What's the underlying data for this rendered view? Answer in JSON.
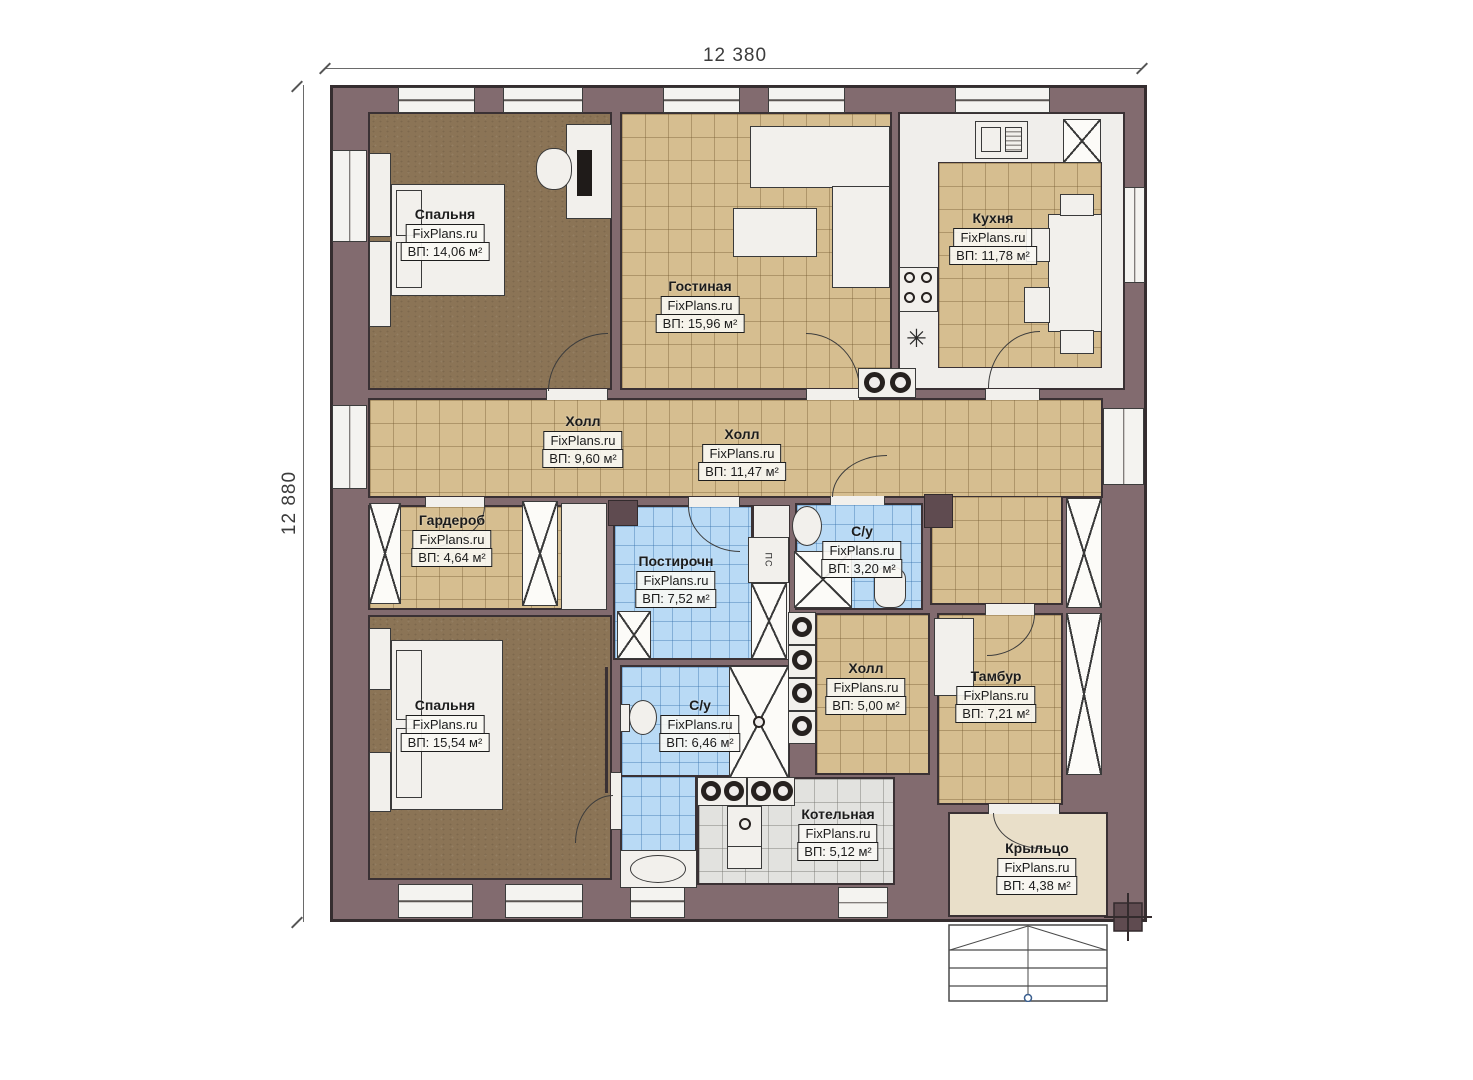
{
  "dimensions": {
    "top": "12 380",
    "left": "12 880"
  },
  "brand": "FixPlans.ru",
  "rooms": [
    {
      "name": "Спальня",
      "area": "ВП: 14,06 м²"
    },
    {
      "name": "Гостиная",
      "area": "ВП: 15,96 м²"
    },
    {
      "name": "Кухня",
      "area": "ВП: 11,78 м²"
    },
    {
      "name": "Холл",
      "area": "ВП: 9,60 м²"
    },
    {
      "name": "Холл",
      "area": "ВП: 11,47 м²"
    },
    {
      "name": "Гардероб",
      "area": "ВП: 4,64 м²"
    },
    {
      "name": "Постирочн",
      "area": "ВП: 7,52 м²"
    },
    {
      "name": "С/у",
      "area": "ВП: 3,20 м²"
    },
    {
      "name": "Спальня",
      "area": "ВП: 15,54 м²"
    },
    {
      "name": "С/у",
      "area": "ВП: 6,46 м²"
    },
    {
      "name": "Холл",
      "area": "ВП: 5,00 м²"
    },
    {
      "name": "Тамбур",
      "area": "ВП: 7,21 м²"
    },
    {
      "name": "Котельная",
      "area": "ВП: 5,12 м²"
    },
    {
      "name": "Крыльцо",
      "area": "ВП: 4,38 м²"
    }
  ],
  "appliances": {
    "washer": "ПС"
  },
  "icons": {
    "snowflake": "✳"
  },
  "colors": {
    "wall": "#826b6f",
    "tan_tile": "#d6be90",
    "blue_tile": "#b9daf5",
    "gray_tile": "#e2e2df",
    "carpet": "#8b7456",
    "porch": "#e9dfc9"
  }
}
